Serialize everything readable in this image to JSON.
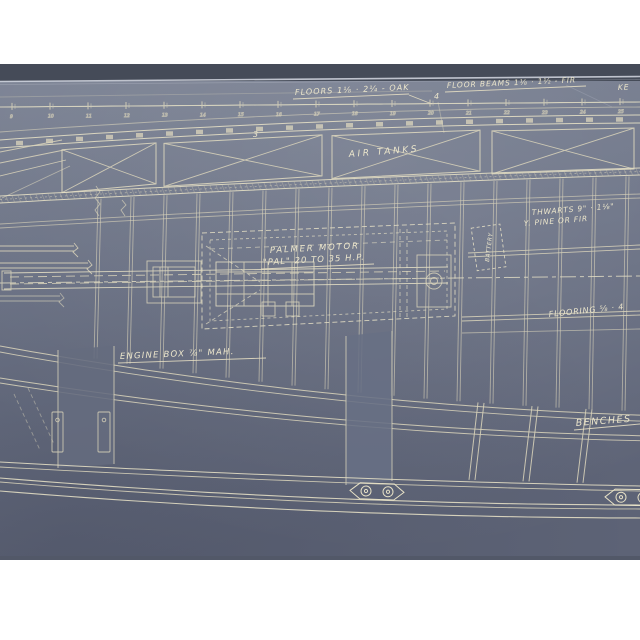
{
  "blueprint": {
    "annotations": {
      "floors": "FLOORS 1⅛ · 2¼ - OAK",
      "floor_beams": "FLOOR BEAMS 1⅛ · 1½ - FIR",
      "keel_partial": "KE",
      "air_tanks": "AIR TANKS",
      "thwarts_line1": "THWARTS 9\" · 1⅛\"",
      "thwarts_line2": "Y. PINE OR FIR",
      "battery": "BATTERY",
      "motor_line1": "PALMER MOTOR",
      "motor_line2": "\"PAL\" 20 TO 35 H.P.",
      "engine_box": "ENGINE BOX ⅞\" MAH.",
      "flooring": "FLOORING ⅝ · 4",
      "benches": "BENCHES",
      "station_3": "3",
      "station_4": "4"
    },
    "scale_ticks": [
      "9",
      "10",
      "11",
      "12",
      "13",
      "14",
      "15",
      "16",
      "17",
      "18",
      "19",
      "20",
      "21",
      "22",
      "23",
      "24",
      "25"
    ],
    "colors": {
      "page_background": "#ffffff",
      "paper_top": "#7d8495",
      "paper_mid": "#6f7689",
      "paper_bottom": "#5d6376",
      "sheet_edge_dark": "#454b58",
      "edge_highlight": "#ccd0da",
      "line_cream": "#d9d3ba",
      "line_bright": "#e7e1c6",
      "text_cream": "#ece6cc"
    }
  }
}
